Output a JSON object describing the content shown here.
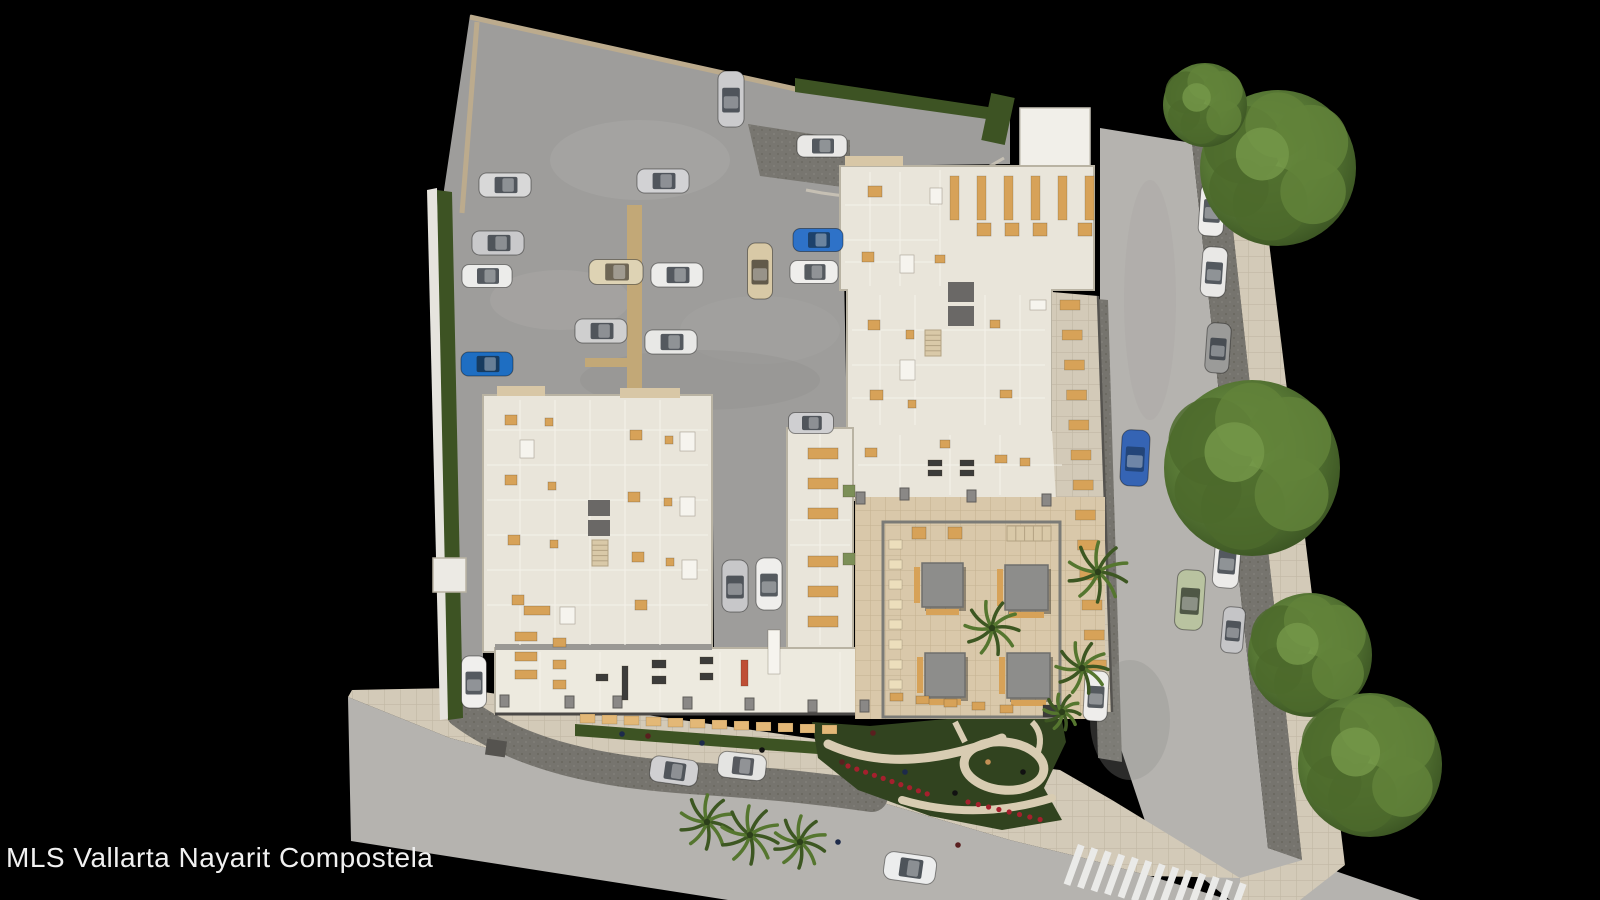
{
  "watermark": "MLS Vallarta Nayarit Compostela",
  "palette": {
    "background": "#000000",
    "lot": "#9e9d9b",
    "road": "#b5b3af",
    "cobble": "#76746e",
    "sidewalk": "#d3cab8",
    "building": "#e9e5da",
    "building_light": "#edeadf",
    "white_building": "#f1efe9",
    "courtyard": "#d9c8aa",
    "hedge": "#3d5323",
    "garden": "#31431f",
    "tree_dark": "#3f5a25",
    "tree_light": "#7ba04e",
    "palm": "#4a6b2c",
    "amber": "#d7a258",
    "awning": "#e3b877",
    "cream": "#ecdebc",
    "white": "#f6f4ee",
    "dark": "#3c3c3a",
    "green": "#7c8f57",
    "red": "#bf4f35",
    "flower": "#a5202d",
    "pergola": "#8d8d8b",
    "curb": "#bcab8d",
    "path": "#d8ccb2",
    "crosswalk": "#eaeae8",
    "text": "#f1f1f1"
  },
  "scene": {
    "cars": [
      {
        "x": 505,
        "y": 185,
        "w": 52,
        "h": 24,
        "c": "#d8d8d8"
      },
      {
        "x": 498,
        "y": 243,
        "w": 52,
        "h": 24,
        "c": "#c9c9cb"
      },
      {
        "x": 487,
        "y": 276,
        "w": 50,
        "h": 23,
        "c": "#ececea"
      },
      {
        "x": 487,
        "y": 364,
        "w": 52,
        "h": 24,
        "c": "#1e6ec2",
        "g": "#16324e"
      },
      {
        "x": 474,
        "y": 682,
        "w": 25,
        "h": 52,
        "c": "#f0efed"
      },
      {
        "x": 663,
        "y": 181,
        "w": 52,
        "h": 24,
        "c": "#d2d2d4"
      },
      {
        "x": 616,
        "y": 272,
        "w": 54,
        "h": 25,
        "c": "#ded3b4",
        "g": "#5a5244"
      },
      {
        "x": 677,
        "y": 275,
        "w": 52,
        "h": 24,
        "c": "#ececea"
      },
      {
        "x": 601,
        "y": 331,
        "w": 52,
        "h": 24,
        "c": "#cfcfcf"
      },
      {
        "x": 671,
        "y": 342,
        "w": 52,
        "h": 24,
        "c": "#e8e8e6"
      },
      {
        "x": 760,
        "y": 271,
        "w": 25,
        "h": 56,
        "c": "#d8c9a6",
        "g": "#4e463a"
      },
      {
        "x": 818,
        "y": 240,
        "w": 50,
        "h": 23,
        "c": "#2e72c8",
        "g": "#1a3a5c"
      },
      {
        "x": 814,
        "y": 272,
        "w": 48,
        "h": 23,
        "c": "#efeeec"
      },
      {
        "x": 731,
        "y": 99,
        "w": 26,
        "h": 56,
        "c": "#cbcbcd"
      },
      {
        "x": 822,
        "y": 146,
        "w": 50,
        "h": 22,
        "c": "#e9e8e6"
      },
      {
        "x": 735,
        "y": 586,
        "w": 26,
        "h": 52,
        "c": "#c7c7c9"
      },
      {
        "x": 769,
        "y": 584,
        "w": 26,
        "h": 52,
        "c": "#efeeec"
      },
      {
        "x": 811,
        "y": 423,
        "w": 45,
        "h": 21,
        "c": "#cfcfd1"
      },
      {
        "x": 1212,
        "y": 210,
        "w": 25,
        "h": 52,
        "c": "#eeedeb",
        "a": 4
      },
      {
        "x": 1214,
        "y": 272,
        "w": 25,
        "h": 50,
        "c": "#e9e8e6",
        "a": 4
      },
      {
        "x": 1218,
        "y": 348,
        "w": 24,
        "h": 50,
        "c": "#9b9b99",
        "a": 4
      },
      {
        "x": 1225,
        "y": 444,
        "w": 25,
        "h": 52,
        "c": "#f0efed",
        "a": 4
      },
      {
        "x": 1227,
        "y": 561,
        "w": 26,
        "h": 54,
        "c": "#ecebe9",
        "a": 5
      },
      {
        "x": 1233,
        "y": 630,
        "w": 22,
        "h": 46,
        "c": "#c5c5c7",
        "a": 5
      },
      {
        "x": 1135,
        "y": 458,
        "w": 28,
        "h": 56,
        "c": "#3564b4",
        "g": "#20406e",
        "a": 3
      },
      {
        "x": 1190,
        "y": 600,
        "w": 28,
        "h": 60,
        "c": "#b9c3a0",
        "g": "#3c4436",
        "a": 4
      },
      {
        "x": 1096,
        "y": 696,
        "w": 24,
        "h": 50,
        "c": "#eeedeb",
        "a": 3
      },
      {
        "x": 674,
        "y": 771,
        "w": 48,
        "h": 26,
        "c": "#d0d0d2",
        "a": 8
      },
      {
        "x": 742,
        "y": 766,
        "w": 48,
        "h": 26,
        "c": "#e4e4e2",
        "g": "#3e4248",
        "a": 6
      },
      {
        "x": 910,
        "y": 868,
        "w": 52,
        "h": 28,
        "c": "#eceded",
        "g": "#33383f",
        "a": 8
      }
    ],
    "trees": [
      [
        1278,
        168,
        78
      ],
      [
        1205,
        105,
        42
      ],
      [
        1252,
        468,
        88
      ],
      [
        1310,
        655,
        62
      ],
      [
        1370,
        765,
        72
      ]
    ],
    "palms": [
      [
        1098,
        572,
        30
      ],
      [
        1082,
        668,
        26
      ],
      [
        707,
        822,
        27
      ],
      [
        750,
        835,
        29
      ],
      [
        800,
        842,
        26
      ],
      [
        992,
        628,
        27
      ],
      [
        1062,
        712,
        18
      ]
    ],
    "people": [
      [
        648,
        736,
        "#5a1f1f"
      ],
      [
        702,
        743,
        "#1d2a4a"
      ],
      [
        762,
        750,
        "#111111"
      ],
      [
        842,
        762,
        "#5a1f1f"
      ],
      [
        905,
        772,
        "#1d2a4a"
      ],
      [
        955,
        793,
        "#111111"
      ],
      [
        988,
        762,
        "#c49055"
      ],
      [
        873,
        733,
        "#5a1f1f"
      ],
      [
        622,
        734,
        "#1d2a4a"
      ],
      [
        1023,
        772,
        "#111111"
      ],
      [
        958,
        845,
        "#5a1f1f"
      ],
      [
        838,
        842,
        "#1d2a4a"
      ]
    ],
    "pergolas": [
      [
        922,
        563,
        41,
        44
      ],
      [
        1005,
        565,
        43,
        45
      ],
      [
        925,
        653,
        40,
        44
      ],
      [
        1007,
        653,
        43,
        45
      ]
    ],
    "cores": [
      [
        948,
        282,
        26,
        20
      ],
      [
        948,
        306,
        26,
        20
      ],
      [
        588,
        500,
        22,
        16
      ],
      [
        588,
        520,
        22,
        16
      ]
    ],
    "stairs": [
      [
        925,
        330,
        16,
        26,
        "v"
      ],
      [
        592,
        540,
        16,
        26,
        "v"
      ],
      [
        1007,
        526,
        44,
        15,
        "h"
      ]
    ],
    "pillars": [
      [
        500,
        695
      ],
      [
        565,
        696
      ],
      [
        613,
        696
      ],
      [
        683,
        697
      ],
      [
        745,
        698
      ],
      [
        808,
        700
      ],
      [
        860,
        700
      ],
      [
        900,
        488
      ],
      [
        967,
        490
      ],
      [
        1042,
        494
      ],
      [
        856,
        492
      ]
    ],
    "furniture": [
      [
        977,
        223,
        14,
        13,
        "amber"
      ],
      [
        1005,
        223,
        14,
        13,
        "amber"
      ],
      [
        1033,
        223,
        14,
        13,
        "amber"
      ],
      [
        1078,
        223,
        14,
        13,
        "amber"
      ],
      [
        868,
        186,
        14,
        11,
        "amber"
      ],
      [
        862,
        252,
        12,
        10,
        "amber"
      ],
      [
        868,
        320,
        12,
        10,
        "amber"
      ],
      [
        906,
        330,
        8,
        9,
        "amber"
      ],
      [
        870,
        390,
        13,
        10,
        "amber"
      ],
      [
        908,
        400,
        8,
        8,
        "amber"
      ],
      [
        865,
        448,
        12,
        9,
        "amber"
      ],
      [
        935,
        255,
        10,
        8,
        "amber"
      ],
      [
        990,
        320,
        10,
        8,
        "amber"
      ],
      [
        1000,
        390,
        12,
        8,
        "amber"
      ],
      [
        940,
        440,
        10,
        8,
        "amber"
      ],
      [
        995,
        455,
        12,
        8,
        "amber"
      ],
      [
        1020,
        458,
        10,
        8,
        "amber"
      ],
      [
        900,
        360,
        15,
        20,
        "white"
      ],
      [
        930,
        188,
        12,
        16,
        "white"
      ],
      [
        900,
        255,
        14,
        18,
        "white"
      ],
      [
        1030,
        300,
        16,
        10,
        "white"
      ],
      [
        928,
        460,
        14,
        6,
        "dark"
      ],
      [
        928,
        470,
        14,
        6,
        "dark"
      ],
      [
        960,
        460,
        14,
        6,
        "dark"
      ],
      [
        960,
        470,
        14,
        6,
        "dark"
      ],
      [
        505,
        415,
        12,
        10,
        "amber"
      ],
      [
        545,
        418,
        8,
        8,
        "amber"
      ],
      [
        505,
        475,
        12,
        10,
        "amber"
      ],
      [
        548,
        482,
        8,
        8,
        "amber"
      ],
      [
        508,
        535,
        12,
        10,
        "amber"
      ],
      [
        550,
        540,
        8,
        8,
        "amber"
      ],
      [
        512,
        595,
        12,
        10,
        "amber"
      ],
      [
        630,
        430,
        12,
        10,
        "amber"
      ],
      [
        665,
        436,
        8,
        8,
        "amber"
      ],
      [
        628,
        492,
        12,
        10,
        "amber"
      ],
      [
        664,
        498,
        8,
        8,
        "amber"
      ],
      [
        632,
        552,
        12,
        10,
        "amber"
      ],
      [
        666,
        558,
        8,
        8,
        "amber"
      ],
      [
        635,
        600,
        12,
        10,
        "amber"
      ],
      [
        680,
        432,
        15,
        19,
        "white"
      ],
      [
        680,
        497,
        15,
        19,
        "white"
      ],
      [
        682,
        560,
        15,
        19,
        "white"
      ],
      [
        560,
        607,
        15,
        17,
        "white"
      ],
      [
        520,
        440,
        14,
        18,
        "white"
      ],
      [
        808,
        448,
        30,
        11,
        "amber"
      ],
      [
        808,
        478,
        30,
        11,
        "amber"
      ],
      [
        808,
        508,
        30,
        11,
        "amber"
      ],
      [
        808,
        556,
        30,
        11,
        "amber"
      ],
      [
        808,
        586,
        30,
        11,
        "amber"
      ],
      [
        808,
        616,
        30,
        11,
        "amber"
      ],
      [
        843,
        485,
        12,
        12,
        "green"
      ],
      [
        843,
        553,
        12,
        12,
        "green"
      ],
      [
        524,
        606,
        26,
        9,
        "amber"
      ],
      [
        515,
        632,
        22,
        9,
        "amber"
      ],
      [
        515,
        652,
        22,
        9,
        "amber"
      ],
      [
        515,
        670,
        22,
        9,
        "amber"
      ],
      [
        553,
        638,
        13,
        9,
        "amber"
      ],
      [
        553,
        660,
        13,
        9,
        "amber"
      ],
      [
        553,
        680,
        13,
        9,
        "amber"
      ],
      [
        596,
        674,
        12,
        7,
        "dark"
      ],
      [
        622,
        666,
        6,
        34,
        "dark"
      ],
      [
        652,
        660,
        14,
        8,
        "dark"
      ],
      [
        652,
        676,
        14,
        8,
        "dark"
      ],
      [
        700,
        657,
        13,
        7,
        "dark"
      ],
      [
        700,
        673,
        13,
        7,
        "dark"
      ],
      [
        741,
        660,
        7,
        26,
        "red"
      ],
      [
        768,
        630,
        12,
        44,
        "white"
      ],
      [
        912,
        527,
        14,
        12,
        "amber"
      ],
      [
        948,
        527,
        14,
        12,
        "amber"
      ],
      [
        890,
        693,
        13,
        8,
        "amber"
      ],
      [
        916,
        696,
        13,
        8,
        "amber"
      ],
      [
        944,
        699,
        13,
        8,
        "amber"
      ],
      [
        972,
        702,
        13,
        8,
        "amber"
      ],
      [
        1000,
        705,
        13,
        8,
        "amber"
      ],
      [
        1043,
        705,
        20,
        12,
        "dark"
      ]
    ],
    "rows": {
      "restaurant_tables": {
        "x0": 950,
        "y0": 176,
        "dx": 27,
        "dy": 0,
        "count": 6,
        "w": 9,
        "h": 44,
        "color": "amber"
      },
      "terrace_tables": {
        "x0": 1060,
        "y0": 300,
        "dx": 2.2,
        "dy": 30,
        "count": 13,
        "w": 20,
        "h": 10,
        "color": "amber"
      },
      "awnings": {
        "x0": 580,
        "y0": 714,
        "dx": 22,
        "dy": 1.0,
        "count": 12,
        "w": 15,
        "h": 9,
        "color": "awning"
      },
      "courtyard_chairs": {
        "x0": 889,
        "y0": 540,
        "dx": 0,
        "dy": 20,
        "count": 8,
        "w": 13,
        "h": 9,
        "color": "cream"
      }
    },
    "crosswalk": {
      "x0": 1078,
      "y0": 844,
      "dx": 13.5,
      "dy": 3.2,
      "count": 13,
      "w": 7,
      "len": 42,
      "angle": 20
    }
  }
}
